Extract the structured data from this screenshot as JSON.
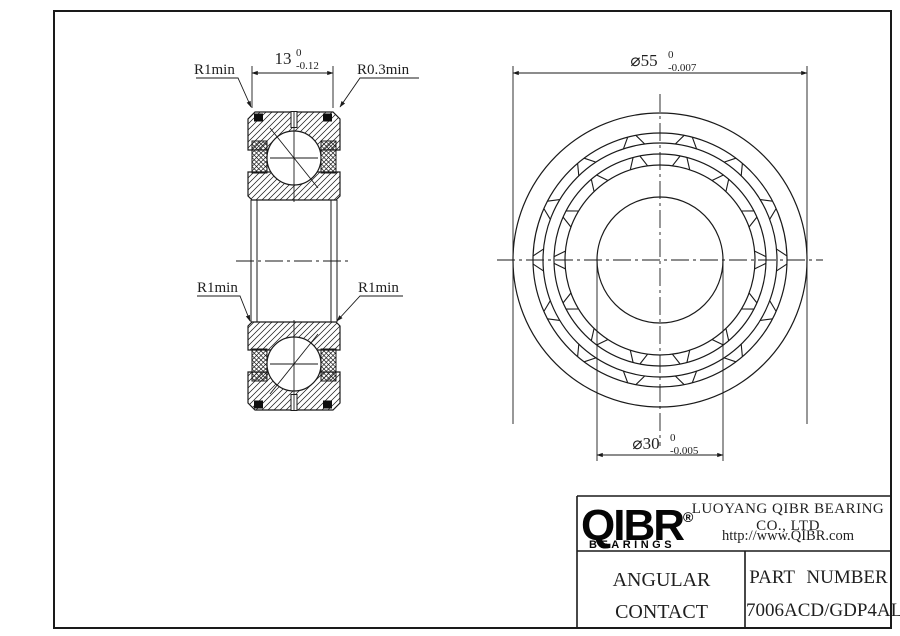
{
  "section_view": {
    "width_dim": {
      "value": "13",
      "tol_top": "0",
      "tol_bot": "-0.12"
    },
    "label_r1min_top": "R1min",
    "label_r03min": "R0.3min",
    "label_r1min_mid_left": "R1min",
    "label_r1min_mid_right": "R1min"
  },
  "front_view": {
    "od_dim": {
      "value": "⌀55",
      "tol_top": "0",
      "tol_bot": "-0.007"
    },
    "bore_dim": {
      "value": "⌀30",
      "tol_top": "0",
      "tol_bot": "-0.005"
    }
  },
  "title_block": {
    "logo": "QIBR",
    "logo_reg": "®",
    "logo_sub": "BEARINGS",
    "company": "LUOYANG QIBR BEARING CO., LTD",
    "website": "http://www.QIBR.com",
    "product_line1": "ANGULAR CONTACT",
    "product_line2": "BALL BEARING",
    "part_label": "PART NUMBER",
    "part_number": "7006ACD/GDP4AL"
  },
  "colors": {
    "line": "#1a1a1a",
    "background": "#ffffff"
  }
}
